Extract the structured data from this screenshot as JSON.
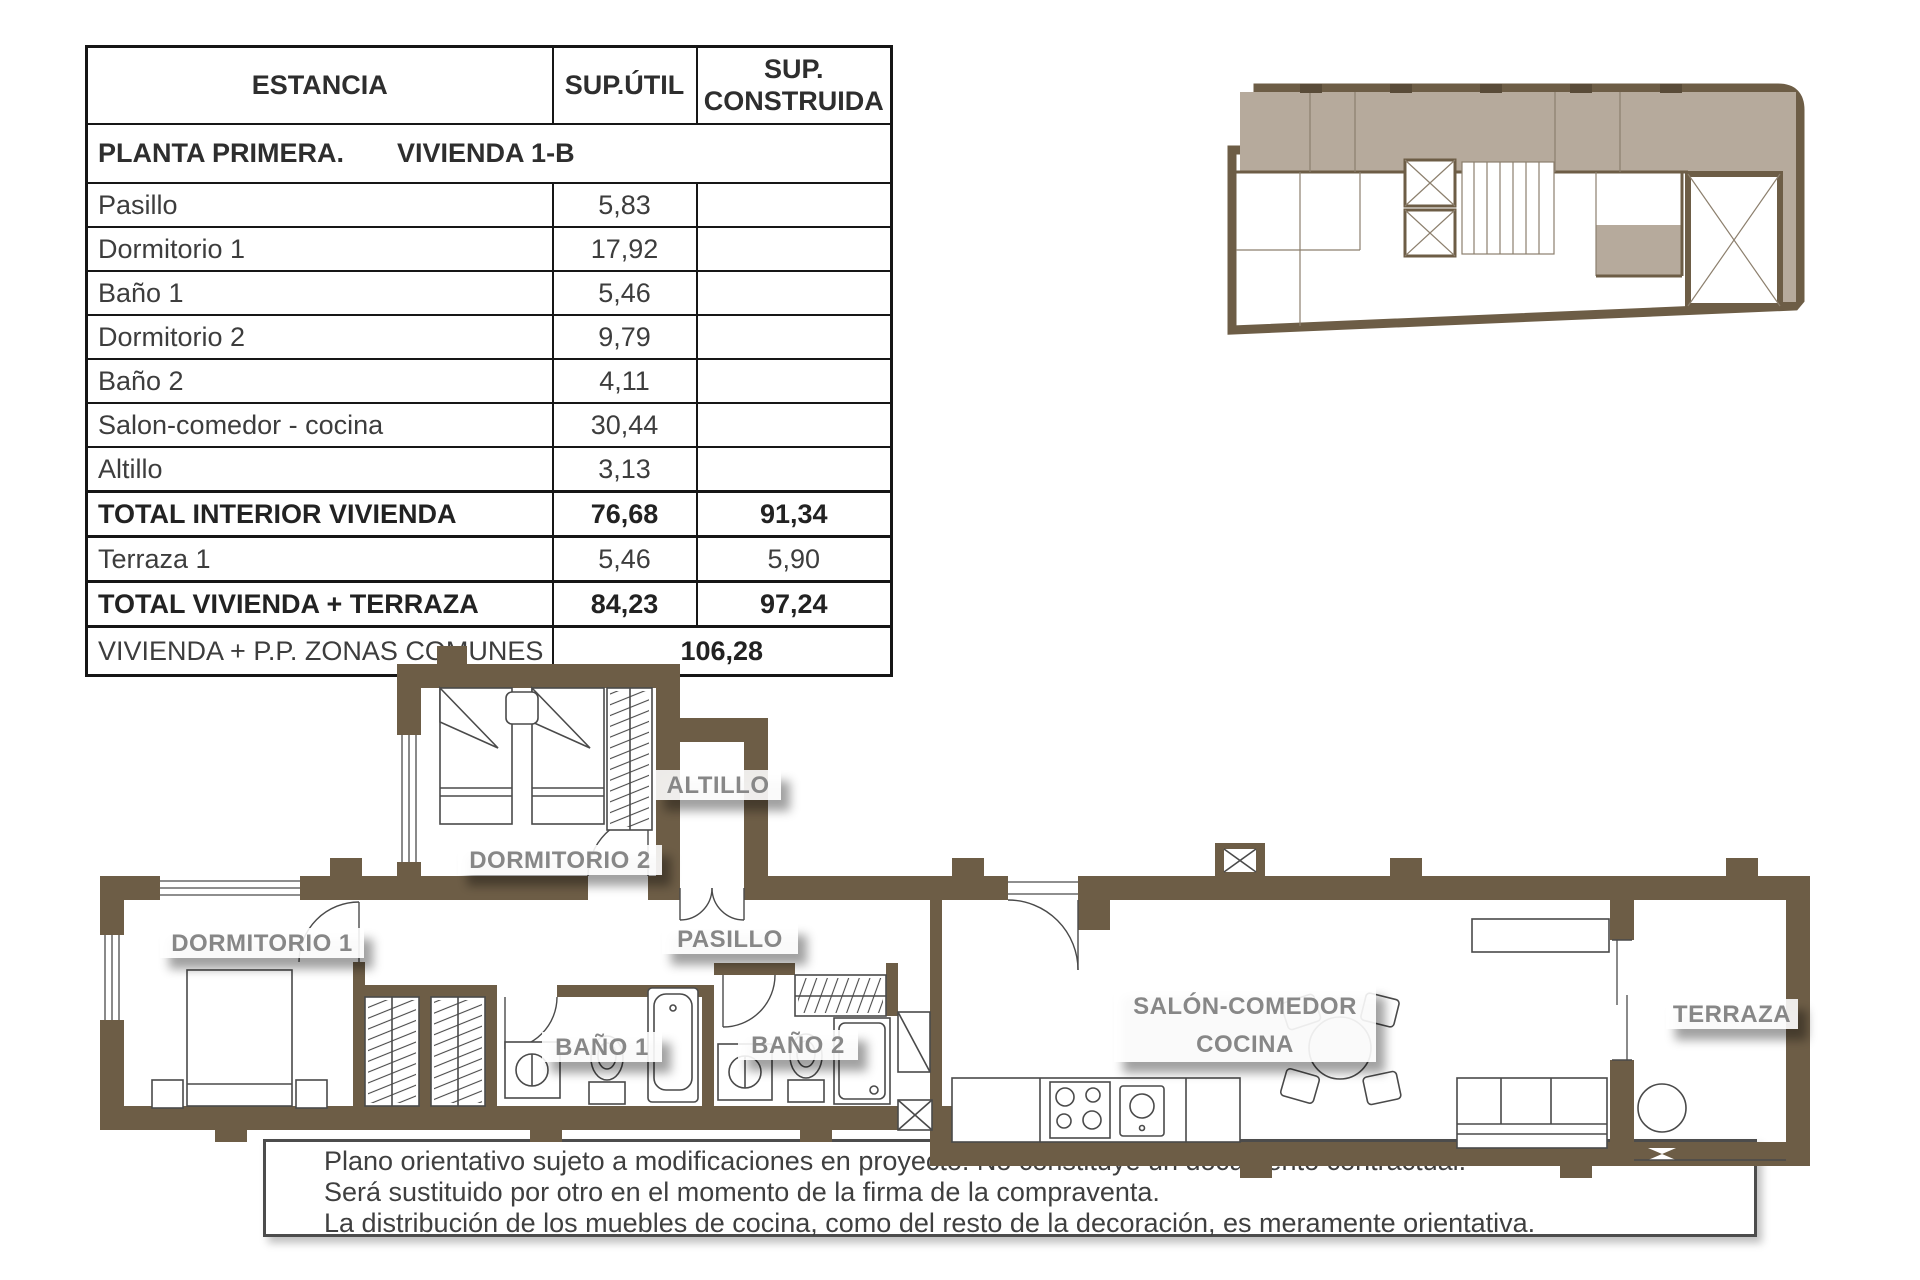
{
  "table": {
    "headers": {
      "estancia": "ESTANCIA",
      "sup_util": "SUP.ÚTIL",
      "sup_construida": "SUP. CONSTRUIDA"
    },
    "section_title_left": "PLANTA PRIMERA.",
    "section_title_right": "VIVIENDA 1-B",
    "rows": [
      {
        "label": "Pasillo",
        "util": "5,83",
        "construida": ""
      },
      {
        "label": "Dormitorio 1",
        "util": "17,92",
        "construida": ""
      },
      {
        "label": "Baño 1",
        "util": "5,46",
        "construida": ""
      },
      {
        "label": "Dormitorio 2",
        "util": "9,79",
        "construida": ""
      },
      {
        "label": "Baño 2",
        "util": "4,11",
        "construida": ""
      },
      {
        "label": "Salon-comedor - cocina",
        "util": "30,44",
        "construida": ""
      },
      {
        "label": "Altillo",
        "util": "3,13",
        "construida": ""
      },
      {
        "label": "TOTAL INTERIOR VIVIENDA",
        "util": "76,68",
        "construida": "91,34"
      },
      {
        "label": "Terraza 1",
        "util": "5,46",
        "construida": "5,90"
      },
      {
        "label": "TOTAL VIVIENDA + TERRAZA",
        "util": "84,23",
        "construida": "97,24"
      }
    ],
    "footer": {
      "label": "VIVIENDA + P.P. ZONAS COMUNES",
      "value": "106,28"
    }
  },
  "plan": {
    "labels": {
      "dormitorio1": "DORMITORIO 1",
      "dormitorio2": "DORMITORIO 2",
      "altillo": "ALTILLO",
      "pasillo": "PASILLO",
      "bano1": "BAÑO 1",
      "bano2": "BAÑO 2",
      "salon_line1": "SALÓN-COMEDOR",
      "salon_line2": "COCINA",
      "terraza": "TERRAZA"
    }
  },
  "disclaimer": {
    "lines": [
      "Plano orientativo sujeto a modificaciones en proyecto. No constituye un documento contractual.",
      "Será sustituido por otro en el momento de la firma de la compraventa.",
      "La distribución de los muebles de cocina, como del resto de la decoración, es meramente orientativa."
    ]
  },
  "colors": {
    "wall": "#6d5d46",
    "unit_shade": "#b6aa9c",
    "label_gray": "#878787",
    "table_border": "#161616"
  }
}
